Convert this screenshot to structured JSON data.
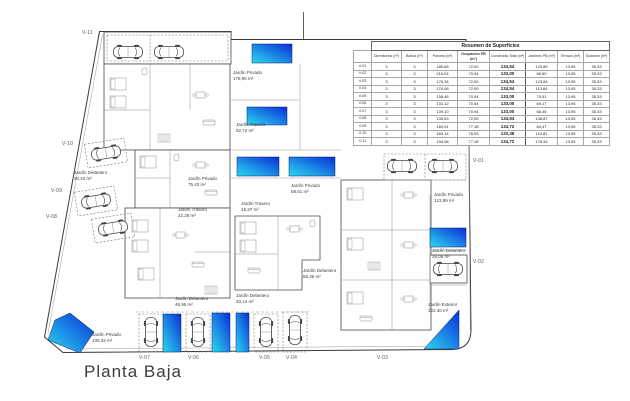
{
  "table": {
    "title": "Resumen de Superficies",
    "columns": [
      "",
      "Dormitorios (nº)",
      "Baños (nº)",
      "Parcela (m²)",
      "Ocupación PB (m²)",
      "Construida Total (m²)",
      "Jardines PB (m²)",
      "Terraza (m²)",
      "Solarium (m²)"
    ],
    "rows": [
      {
        "id": "V-01",
        "values": [
          "3",
          "3",
          "180,68",
          "72,00",
          "134,54",
          "123,89",
          "13,95",
          "35,33"
        ]
      },
      {
        "id": "V-02",
        "values": [
          "3",
          "3",
          "216,04",
          "70,94",
          "133,00",
          "68,50",
          "13,95",
          "35,33"
        ]
      },
      {
        "id": "V-03",
        "values": [
          "3",
          "3",
          "175,34",
          "72,00",
          "134,54",
          "123,84",
          "13,95",
          "35,33"
        ]
      },
      {
        "id": "V-04",
        "values": [
          "3",
          "3",
          "170,08",
          "72,00",
          "134,54",
          "113,84",
          "13,95",
          "35,33"
        ]
      },
      {
        "id": "V-05",
        "values": [
          "3",
          "3",
          "158,46",
          "70,94",
          "133,00",
          "75,51",
          "13,95",
          "35,33"
        ]
      },
      {
        "id": "V-06",
        "values": [
          "3",
          "3",
          "131,12",
          "70,94",
          "133,00",
          "69,17",
          "13,95",
          "35,33"
        ]
      },
      {
        "id": "V-07",
        "values": [
          "3",
          "3",
          "139,10",
          "70,94",
          "133,00",
          "68,46",
          "13,95",
          "35,33"
        ]
      },
      {
        "id": "V-08",
        "values": [
          "3",
          "3",
          "135,63",
          "72,00",
          "134,54",
          "138,87",
          "13,95",
          "35,33"
        ]
      },
      {
        "id": "V-09",
        "values": [
          "3",
          "3",
          "169,01",
          "77,18",
          "134,72",
          "84,47",
          "13,95",
          "35,33"
        ]
      },
      {
        "id": "V-10",
        "values": [
          "3",
          "3",
          "169,14",
          "76,53",
          "133,38",
          "113,81",
          "13,95",
          "35,33"
        ]
      },
      {
        "id": "V-11",
        "values": [
          "3",
          "3",
          "194,08",
          "77,18",
          "134,72",
          "178,44",
          "13,95",
          "35,33"
        ]
      }
    ]
  },
  "plan": {
    "title": "Planta Baja",
    "garden_labels": [
      {
        "name": "Jardín Privado",
        "area": "179,95 m²"
      },
      {
        "name": "Jardín Trasero",
        "area": "92,72 m²"
      },
      {
        "name": "Jardín Privado",
        "area": "75,43 m²"
      },
      {
        "name": "Jardín Privado",
        "area": "58,61 m²"
      },
      {
        "name": "Jardín Trasero",
        "area": "19,37 m²"
      },
      {
        "name": "Jardín Trasero",
        "area": "22,28 m²"
      },
      {
        "name": "Jardín Delantero",
        "area": "30,24 m²"
      },
      {
        "name": "Jardín Privado",
        "area": "123,89 m²"
      },
      {
        "name": "Jardín Delantero",
        "area": "35,05 m²"
      },
      {
        "name": "Jardín Privado",
        "area": "130,32 m²"
      },
      {
        "name": "Jardín Delantero",
        "area": "46,95 m²"
      },
      {
        "name": "Jardín Delantero",
        "area": "33,14 m²"
      },
      {
        "name": "Jardín Delantero",
        "area": "55,36 m²"
      },
      {
        "name": "Jardín Exterior",
        "area": "122,40 m²"
      }
    ],
    "road_labels": [
      "V-01",
      "V-02",
      "V-03",
      "V-04",
      "V-05",
      "V-06",
      "V-07",
      "V-08",
      "V-09",
      "V-10",
      "V-11"
    ],
    "colors": {
      "pool_start": "#2bd9f0",
      "pool_end": "#0a2ed8",
      "line": "#3a3a3a"
    }
  }
}
